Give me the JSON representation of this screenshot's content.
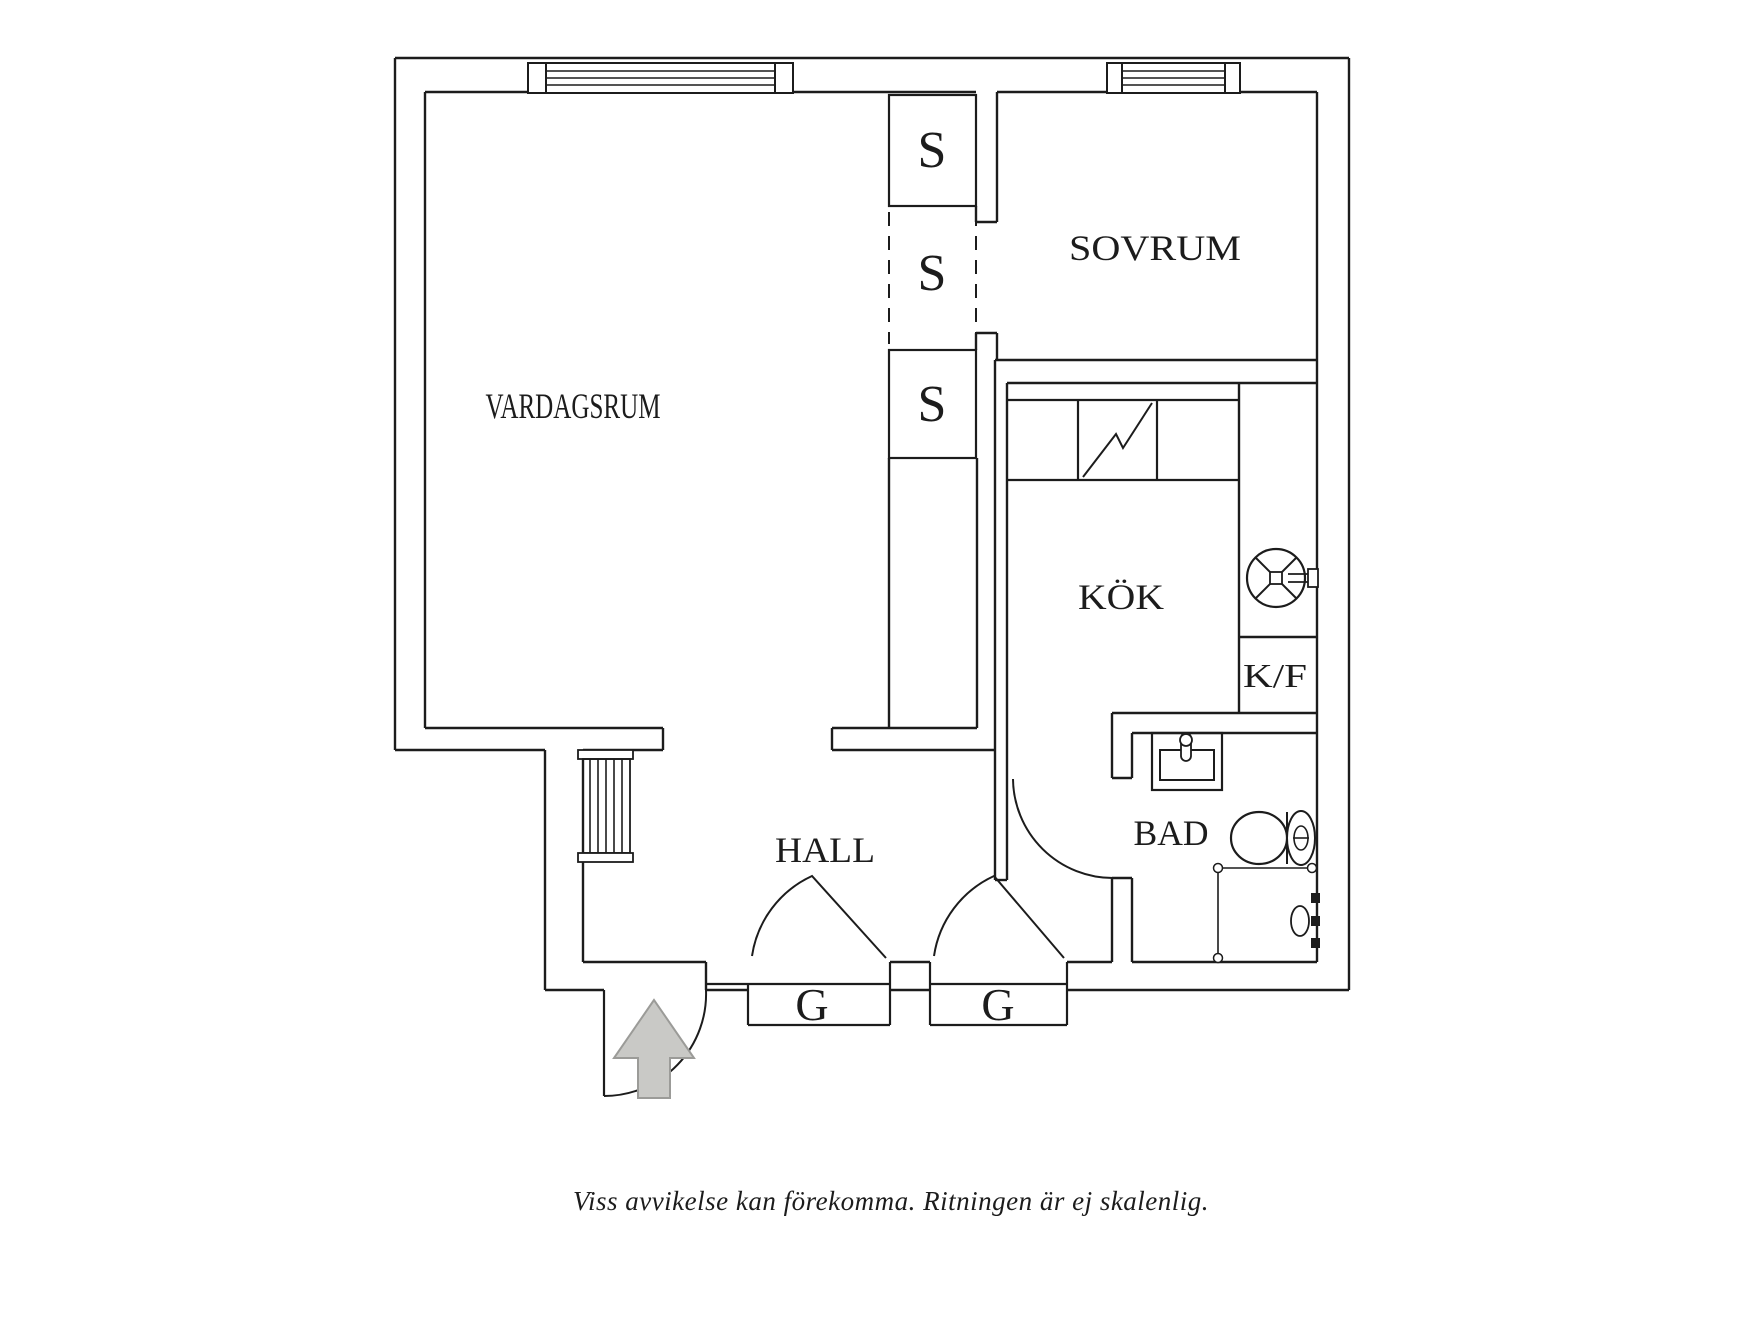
{
  "title": "Floor plan",
  "caption": "Viss avvikelse kan förekomma. Ritningen är ej skalenlig.",
  "colors": {
    "ink": "#1c1c1c",
    "arrow_fill": "#c9c9c6",
    "arrow_stroke": "#9b9b98",
    "background": "#ffffff"
  },
  "rooms": [
    {
      "id": "vardagsrum",
      "label": "VARDAGSRUM"
    },
    {
      "id": "sovrum",
      "label": "SOVRUM"
    },
    {
      "id": "kok",
      "label": "KÖK"
    },
    {
      "id": "hall",
      "label": "HALL"
    },
    {
      "id": "bad",
      "label": "BAD"
    },
    {
      "id": "kf",
      "label": "K/F"
    },
    {
      "id": "closet-1",
      "label": "S"
    },
    {
      "id": "closet-2",
      "label": "S"
    },
    {
      "id": "closet-3",
      "label": "S"
    },
    {
      "id": "wardrobe-1",
      "label": "G"
    },
    {
      "id": "wardrobe-2",
      "label": "G"
    }
  ],
  "shapes": [
    {
      "t": "line",
      "n": "exterior-wall",
      "x1": 395,
      "y1": 58,
      "x2": 1349,
      "y2": 58
    },
    {
      "t": "line",
      "n": "exterior-wall",
      "x1": 1349,
      "y1": 58,
      "x2": 1349,
      "y2": 990
    },
    {
      "t": "line",
      "n": "exterior-wall",
      "x1": 1067,
      "y1": 990,
      "x2": 1349,
      "y2": 990
    },
    {
      "t": "line",
      "n": "exterior-wall",
      "x1": 890,
      "y1": 990,
      "x2": 930,
      "y2": 990
    },
    {
      "t": "line",
      "n": "exterior-wall",
      "x1": 706,
      "y1": 990,
      "x2": 748,
      "y2": 990
    },
    {
      "t": "line",
      "n": "exterior-wall",
      "x1": 545,
      "y1": 990,
      "x2": 604,
      "y2": 990
    },
    {
      "t": "line",
      "n": "exterior-wall",
      "x1": 545,
      "y1": 750,
      "x2": 545,
      "y2": 990
    },
    {
      "t": "line",
      "n": "exterior-wall",
      "x1": 395,
      "y1": 750,
      "x2": 545,
      "y2": 750
    },
    {
      "t": "line",
      "n": "exterior-wall",
      "x1": 395,
      "y1": 58,
      "x2": 395,
      "y2": 750
    },
    {
      "t": "line",
      "n": "wall-line",
      "x1": 425,
      "y1": 92,
      "x2": 976,
      "y2": 92
    },
    {
      "t": "line",
      "n": "wall-line",
      "x1": 997,
      "y1": 92,
      "x2": 1317,
      "y2": 92
    },
    {
      "t": "line",
      "n": "wall-line",
      "x1": 425,
      "y1": 92,
      "x2": 425,
      "y2": 728
    },
    {
      "t": "line",
      "n": "wall-line",
      "x1": 425,
      "y1": 728,
      "x2": 663,
      "y2": 728
    },
    {
      "t": "line",
      "n": "wall-line",
      "x1": 663,
      "y1": 728,
      "x2": 663,
      "y2": 750
    },
    {
      "t": "line",
      "n": "wall-line",
      "x1": 583,
      "y1": 750,
      "x2": 663,
      "y2": 750
    },
    {
      "t": "line",
      "n": "wall-line",
      "x1": 583,
      "y1": 750,
      "x2": 583,
      "y2": 962
    },
    {
      "t": "line",
      "n": "wall-line",
      "x1": 583,
      "y1": 962,
      "x2": 706,
      "y2": 962
    },
    {
      "t": "line",
      "n": "wall-line",
      "x1": 706,
      "y1": 962,
      "x2": 706,
      "y2": 990
    },
    {
      "t": "line",
      "n": "wall-line",
      "x1": 890,
      "y1": 962,
      "x2": 930,
      "y2": 962
    },
    {
      "t": "line",
      "n": "wall-line",
      "x1": 1067,
      "y1": 962,
      "x2": 1112,
      "y2": 962
    },
    {
      "t": "line",
      "n": "wall-line",
      "x1": 1132,
      "y1": 962,
      "x2": 1317,
      "y2": 962
    },
    {
      "t": "line",
      "n": "wall-line",
      "x1": 832,
      "y1": 728,
      "x2": 977,
      "y2": 728
    },
    {
      "t": "line",
      "n": "wall-line",
      "x1": 832,
      "y1": 728,
      "x2": 832,
      "y2": 750
    },
    {
      "t": "line",
      "n": "wall-line",
      "x1": 832,
      "y1": 750,
      "x2": 995,
      "y2": 750
    },
    {
      "t": "line",
      "n": "wall-line",
      "x1": 889,
      "y1": 458,
      "x2": 889,
      "y2": 728
    },
    {
      "t": "line",
      "n": "wall-line",
      "x1": 977,
      "y1": 458,
      "x2": 977,
      "y2": 728
    },
    {
      "t": "line",
      "n": "wall-line",
      "x1": 995,
      "y1": 360,
      "x2": 995,
      "y2": 880
    },
    {
      "t": "line",
      "n": "wall-line",
      "x1": 1007,
      "y1": 383,
      "x2": 1007,
      "y2": 880
    },
    {
      "t": "line",
      "n": "wall-line",
      "x1": 995,
      "y1": 880,
      "x2": 1007,
      "y2": 880
    },
    {
      "t": "line",
      "n": "wall-line",
      "x1": 997,
      "y1": 92,
      "x2": 997,
      "y2": 222
    },
    {
      "t": "line",
      "n": "wall-line",
      "x1": 976,
      "y1": 206,
      "x2": 976,
      "y2": 222
    },
    {
      "t": "line",
      "n": "wall-line",
      "x1": 976,
      "y1": 222,
      "x2": 997,
      "y2": 222
    },
    {
      "t": "line",
      "n": "wall-line",
      "x1": 976,
      "y1": 333,
      "x2": 997,
      "y2": 333
    },
    {
      "t": "line",
      "n": "wall-line",
      "x1": 976,
      "y1": 333,
      "x2": 976,
      "y2": 350
    },
    {
      "t": "line",
      "n": "wall-line",
      "x1": 997,
      "y1": 333,
      "x2": 997,
      "y2": 360
    },
    {
      "t": "line",
      "n": "wall-line",
      "x1": 995,
      "y1": 360,
      "x2": 1317,
      "y2": 360
    },
    {
      "t": "line",
      "n": "wall-line",
      "x1": 1007,
      "y1": 383,
      "x2": 1317,
      "y2": 383
    },
    {
      "t": "line",
      "n": "wall-line",
      "x1": 1317,
      "y1": 92,
      "x2": 1317,
      "y2": 962
    },
    {
      "t": "line",
      "n": "wall-line",
      "x1": 1239,
      "y1": 383,
      "x2": 1239,
      "y2": 713
    },
    {
      "t": "line",
      "n": "cabinet-divider",
      "x1": 1239,
      "y1": 637,
      "x2": 1317,
      "y2": 637
    },
    {
      "t": "line",
      "n": "wall-line",
      "x1": 1112,
      "y1": 713,
      "x2": 1317,
      "y2": 713
    },
    {
      "t": "line",
      "n": "wall-line",
      "x1": 1132,
      "y1": 733,
      "x2": 1317,
      "y2": 733
    },
    {
      "t": "line",
      "n": "wall-line",
      "x1": 1112,
      "y1": 713,
      "x2": 1112,
      "y2": 778
    },
    {
      "t": "line",
      "n": "wall-line",
      "x1": 1132,
      "y1": 733,
      "x2": 1132,
      "y2": 778
    },
    {
      "t": "line",
      "n": "wall-line",
      "x1": 1112,
      "y1": 778,
      "x2": 1132,
      "y2": 778
    },
    {
      "t": "line",
      "n": "wall-line",
      "x1": 1112,
      "y1": 878,
      "x2": 1112,
      "y2": 962
    },
    {
      "t": "line",
      "n": "wall-line",
      "x1": 1132,
      "y1": 878,
      "x2": 1132,
      "y2": 962
    },
    {
      "t": "line",
      "n": "wall-line",
      "x1": 1112,
      "y1": 878,
      "x2": 1132,
      "y2": 878
    },
    {
      "t": "rect",
      "n": "window",
      "x": 528,
      "y": 63,
      "w": 265,
      "h": 30,
      "f": "#ffffff",
      "sw": 2
    },
    {
      "t": "line",
      "n": "window-glazing",
      "x1": 546,
      "y1": 71,
      "x2": 775,
      "y2": 71,
      "sw": 1.4
    },
    {
      "t": "line",
      "n": "window-glazing",
      "x1": 546,
      "y1": 78,
      "x2": 775,
      "y2": 78,
      "sw": 1.4
    },
    {
      "t": "line",
      "n": "window-glazing",
      "x1": 546,
      "y1": 85,
      "x2": 775,
      "y2": 85,
      "sw": 1.4
    },
    {
      "t": "rect",
      "n": "window-jamb",
      "x": 528,
      "y": 63,
      "w": 18,
      "h": 30,
      "sw": 2
    },
    {
      "t": "rect",
      "n": "window-jamb",
      "x": 775,
      "y": 63,
      "w": 18,
      "h": 30,
      "sw": 2
    },
    {
      "t": "rect",
      "n": "window",
      "x": 1107,
      "y": 63,
      "w": 133,
      "h": 30,
      "f": "#ffffff",
      "sw": 2
    },
    {
      "t": "line",
      "n": "window-glazing",
      "x1": 1122,
      "y1": 71,
      "x2": 1225,
      "y2": 71,
      "sw": 1.4
    },
    {
      "t": "line",
      "n": "window-glazing",
      "x1": 1122,
      "y1": 78,
      "x2": 1225,
      "y2": 78,
      "sw": 1.4
    },
    {
      "t": "line",
      "n": "window-glazing",
      "x1": 1122,
      "y1": 85,
      "x2": 1225,
      "y2": 85,
      "sw": 1.4
    },
    {
      "t": "rect",
      "n": "window-jamb",
      "x": 1107,
      "y": 63,
      "w": 15,
      "h": 30,
      "sw": 2
    },
    {
      "t": "rect",
      "n": "window-jamb",
      "x": 1225,
      "y": 63,
      "w": 15,
      "h": 30,
      "sw": 2
    },
    {
      "t": "rect",
      "n": "s-closet-box",
      "x": 889,
      "y": 95,
      "w": 87,
      "h": 111,
      "sw": 2.2
    },
    {
      "t": "rect",
      "n": "s-closet-box",
      "x": 889,
      "y": 350,
      "w": 87,
      "h": 108,
      "sw": 2.2
    },
    {
      "t": "line",
      "n": "s-closet-dashed",
      "x1": 889,
      "y1": 212,
      "x2": 889,
      "y2": 344,
      "sw": 2,
      "da": "14 10"
    },
    {
      "t": "line",
      "n": "s-closet-dashed",
      "x1": 976,
      "y1": 212,
      "x2": 976,
      "y2": 344,
      "sw": 2,
      "da": "14 10"
    },
    {
      "t": "line",
      "n": "kitchen-counter",
      "x1": 1007,
      "y1": 400,
      "x2": 1239,
      "y2": 400,
      "sw": 2.2
    },
    {
      "t": "line",
      "n": "kitchen-counter",
      "x1": 1007,
      "y1": 480,
      "x2": 1239,
      "y2": 480,
      "sw": 2.2
    },
    {
      "t": "line",
      "n": "kitchen-counter",
      "x1": 1078,
      "y1": 400,
      "x2": 1078,
      "y2": 480,
      "sw": 2.2
    },
    {
      "t": "line",
      "n": "kitchen-counter",
      "x1": 1157,
      "y1": 400,
      "x2": 1157,
      "y2": 480,
      "sw": 2.2
    },
    {
      "t": "path",
      "n": "sink-symbol",
      "d": "M1083,477 L1116,434 L1123,448 L1152,403",
      "sw": 2
    },
    {
      "t": "circle",
      "n": "stove-fan-icon",
      "cx": 1276,
      "cy": 578,
      "r": 29,
      "sw": 2.2
    },
    {
      "t": "line",
      "n": "stove-fan-icon",
      "x1": 1255.5,
      "y1": 557.5,
      "x2": 1296.5,
      "y2": 598.5,
      "sw": 2
    },
    {
      "t": "line",
      "n": "stove-fan-icon",
      "x1": 1296.5,
      "y1": 557.5,
      "x2": 1255.5,
      "y2": 598.5,
      "sw": 2
    },
    {
      "t": "rect",
      "n": "stove-fan-icon",
      "x": 1270,
      "y": 572,
      "w": 12,
      "h": 12,
      "f": "#ffffff",
      "sw": 1.8
    },
    {
      "t": "line",
      "n": "stove-fan-handle",
      "x1": 1288,
      "y1": 574,
      "x2": 1310,
      "y2": 574,
      "sw": 1.8
    },
    {
      "t": "line",
      "n": "stove-fan-handle",
      "x1": 1288,
      "y1": 582,
      "x2": 1310,
      "y2": 582,
      "sw": 1.8
    },
    {
      "t": "rect",
      "n": "stove-fan-handle",
      "x": 1308,
      "y": 569,
      "w": 10,
      "h": 18,
      "f": "#ffffff",
      "sw": 1.8
    },
    {
      "t": "rect",
      "n": "bath-sink-counter",
      "x": 1152,
      "y": 733,
      "w": 70,
      "h": 57,
      "sw": 2.2
    },
    {
      "t": "rect",
      "n": "bath-sink-basin",
      "x": 1160,
      "y": 750,
      "w": 54,
      "h": 30,
      "sw": 2
    },
    {
      "t": "rect",
      "n": "bath-faucet-icon",
      "x": 1181,
      "y": 733,
      "w": 10,
      "h": 28,
      "rx": 5,
      "f": "#ffffff",
      "sw": 1.8
    },
    {
      "t": "circle",
      "n": "bath-faucet-icon",
      "cx": 1186,
      "cy": 740,
      "r": 6,
      "f": "#ffffff",
      "sw": 1.8
    },
    {
      "t": "ellipse",
      "n": "toilet-bowl",
      "cx": 1259,
      "cy": 838,
      "rx": 28,
      "ry": 26,
      "f": "#ffffff",
      "sw": 2.2
    },
    {
      "t": "line",
      "n": "toilet-tank",
      "x1": 1287,
      "y1": 812,
      "x2": 1287,
      "y2": 864,
      "sw": 2
    },
    {
      "t": "ellipse",
      "n": "toilet-tank",
      "cx": 1301,
      "cy": 838,
      "rx": 14,
      "ry": 27,
      "f": "#ffffff",
      "sw": 2
    },
    {
      "t": "ellipse",
      "n": "toilet-flush",
      "cx": 1301,
      "cy": 838,
      "rx": 7,
      "ry": 12,
      "sw": 1.6
    },
    {
      "t": "line",
      "n": "toilet-flush",
      "x1": 1293,
      "y1": 838,
      "x2": 1309,
      "y2": 838,
      "sw": 1.6
    },
    {
      "t": "line",
      "n": "shower-rail",
      "x1": 1218,
      "y1": 868,
      "x2": 1312,
      "y2": 868,
      "sw": 1.6
    },
    {
      "t": "line",
      "n": "shower-rail",
      "x1": 1218,
      "y1": 868,
      "x2": 1218,
      "y2": 958,
      "sw": 1.6
    },
    {
      "t": "circle",
      "n": "shower-rail-end",
      "cx": 1218,
      "cy": 868,
      "r": 4.5,
      "f": "#ffffff",
      "sw": 1.5
    },
    {
      "t": "circle",
      "n": "shower-rail-end",
      "cx": 1312,
      "cy": 868,
      "r": 4.5,
      "f": "#ffffff",
      "sw": 1.5
    },
    {
      "t": "circle",
      "n": "shower-rail-end",
      "cx": 1218,
      "cy": 958,
      "r": 4.5,
      "f": "#ffffff",
      "sw": 1.5
    },
    {
      "t": "ellipse",
      "n": "shower-head-icon",
      "cx": 1300,
      "cy": 921,
      "rx": 9,
      "ry": 15,
      "f": "#ffffff",
      "sw": 1.8
    },
    {
      "t": "rect",
      "n": "shower-bracket",
      "x": 1311,
      "y": 893,
      "w": 9,
      "h": 10,
      "f": "#1c1c1c",
      "sw": 0
    },
    {
      "t": "rect",
      "n": "shower-bracket",
      "x": 1311,
      "y": 916,
      "w": 9,
      "h": 10,
      "f": "#1c1c1c",
      "sw": 0
    },
    {
      "t": "rect",
      "n": "shower-bracket",
      "x": 1311,
      "y": 938,
      "w": 9,
      "h": 10,
      "f": "#1c1c1c",
      "sw": 0
    },
    {
      "t": "path",
      "n": "bathroom-door-arc",
      "d": "M1013,779 A100,100 0 0 0 1113,878",
      "sw": 2
    },
    {
      "t": "line",
      "n": "g-wardrobe-step",
      "x1": 706,
      "y1": 984,
      "x2": 748,
      "y2": 984,
      "sw": 2.2
    },
    {
      "t": "line",
      "n": "g-wardrobe-box",
      "x1": 748,
      "y1": 984,
      "x2": 890,
      "y2": 984,
      "sw": 2.2
    },
    {
      "t": "line",
      "n": "g-wardrobe-box",
      "x1": 748,
      "y1": 984,
      "x2": 748,
      "y2": 1025,
      "sw": 2.2
    },
    {
      "t": "line",
      "n": "g-wardrobe-box",
      "x1": 748,
      "y1": 1025,
      "x2": 890,
      "y2": 1025,
      "sw": 2.2
    },
    {
      "t": "line",
      "n": "g-wardrobe-box",
      "x1": 890,
      "y1": 962,
      "x2": 890,
      "y2": 1025,
      "sw": 2.2
    },
    {
      "t": "line",
      "n": "g-wardrobe-box",
      "x1": 930,
      "y1": 984,
      "x2": 1067,
      "y2": 984,
      "sw": 2.2
    },
    {
      "t": "line",
      "n": "g-wardrobe-box",
      "x1": 930,
      "y1": 962,
      "x2": 930,
      "y2": 1025,
      "sw": 2.2
    },
    {
      "t": "line",
      "n": "g-wardrobe-box",
      "x1": 930,
      "y1": 1025,
      "x2": 1067,
      "y2": 1025,
      "sw": 2.2
    },
    {
      "t": "line",
      "n": "g-wardrobe-box",
      "x1": 1067,
      "y1": 962,
      "x2": 1067,
      "y2": 1025,
      "sw": 2.2
    },
    {
      "t": "path",
      "n": "g-wardrobe-door-arc",
      "d": "M752,956 A105,105 0 0 1 812,876 L886,958",
      "sw": 2
    },
    {
      "t": "path",
      "n": "g-wardrobe-door-arc",
      "d": "M934,956 A105,105 0 0 1 994,876 L1064,958",
      "sw": 2
    },
    {
      "t": "rect",
      "n": "radiator",
      "x": 578,
      "y": 750,
      "w": 55,
      "h": 9,
      "f": "#ffffff",
      "sw": 1.8
    },
    {
      "t": "rect",
      "n": "radiator",
      "x": 583,
      "y": 759,
      "w": 47,
      "h": 94,
      "sw": 1.8
    },
    {
      "t": "line",
      "n": "radiator-bar",
      "x1": 590,
      "y1": 759,
      "x2": 590,
      "y2": 853,
      "sw": 1.6
    },
    {
      "t": "line",
      "n": "radiator-bar",
      "x1": 598,
      "y1": 759,
      "x2": 598,
      "y2": 853,
      "sw": 1.6
    },
    {
      "t": "line",
      "n": "radiator-bar",
      "x1": 606,
      "y1": 759,
      "x2": 606,
      "y2": 853,
      "sw": 1.6
    },
    {
      "t": "line",
      "n": "radiator-bar",
      "x1": 614,
      "y1": 759,
      "x2": 614,
      "y2": 853,
      "sw": 1.6
    },
    {
      "t": "line",
      "n": "radiator-bar",
      "x1": 622,
      "y1": 759,
      "x2": 622,
      "y2": 853,
      "sw": 1.6
    },
    {
      "t": "rect",
      "n": "radiator",
      "x": 578,
      "y": 853,
      "w": 55,
      "h": 9,
      "f": "#ffffff",
      "sw": 1.8
    },
    {
      "t": "line",
      "n": "entry-door-leaf",
      "x1": 604,
      "y1": 990,
      "x2": 604,
      "y2": 1096,
      "sw": 2.2
    },
    {
      "t": "path",
      "n": "entry-door-arc",
      "d": "M604,1096 A102,102 0 0 0 706,990",
      "sw": 2
    },
    {
      "t": "polygon",
      "n": "entry-arrow-icon",
      "points": "654,1000 614,1058 638,1058 638,1098 670,1098 670,1058 694,1058",
      "f": "#c9c9c6",
      "st": "#9b9b98",
      "sw": 2
    },
    {
      "t": "text",
      "n": "room-label-vardagsrum",
      "x": 573,
      "y": 418,
      "fs": 36,
      "tl": 175,
      "text": "VARDAGSRUM"
    },
    {
      "t": "text",
      "n": "room-label-sovrum",
      "x": 1155,
      "y": 260,
      "fs": 36,
      "tl": 172,
      "text": "SOVRUM"
    },
    {
      "t": "text",
      "n": "room-label-kok",
      "x": 1121,
      "y": 609,
      "fs": 36,
      "tl": 86,
      "text": "KÖK"
    },
    {
      "t": "text",
      "n": "room-label-hall",
      "x": 825,
      "y": 862,
      "fs": 36,
      "tl": 100,
      "text": "HALL"
    },
    {
      "t": "text",
      "n": "room-label-bad",
      "x": 1171,
      "y": 845,
      "fs": 36,
      "tl": 75,
      "text": "BAD"
    },
    {
      "t": "text",
      "n": "label-kf",
      "x": 1275,
      "y": 687,
      "fs": 34,
      "tl": 64,
      "text": "K/F"
    },
    {
      "t": "text",
      "n": "closet-label-s1",
      "x": 932,
      "y": 167,
      "fs": 52,
      "text": "S"
    },
    {
      "t": "text",
      "n": "closet-label-s2",
      "x": 932,
      "y": 290,
      "fs": 52,
      "text": "S"
    },
    {
      "t": "text",
      "n": "closet-label-s3",
      "x": 932,
      "y": 421,
      "fs": 52,
      "text": "S"
    },
    {
      "t": "text",
      "n": "wardrobe-label-g1",
      "x": 812,
      "y": 1020,
      "fs": 46,
      "text": "G"
    },
    {
      "t": "text",
      "n": "wardrobe-label-g2",
      "x": 998,
      "y": 1020,
      "fs": 46,
      "text": "G"
    }
  ]
}
